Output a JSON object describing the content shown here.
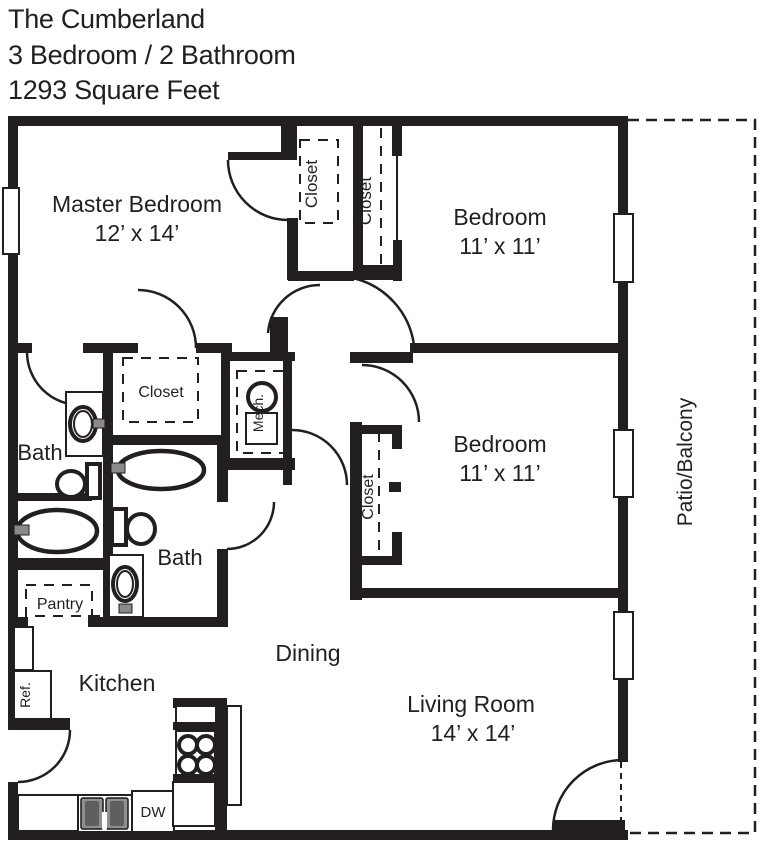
{
  "header": {
    "title": "The Cumberland",
    "subtitle": "3 Bedroom / 2 Bathroom",
    "area": "1293 Square Feet"
  },
  "rooms": {
    "master_bedroom": {
      "label": "Master Bedroom",
      "dims": "12’ x 14’"
    },
    "bedroom_top": {
      "label": "Bedroom",
      "dims": "11’ x 11’"
    },
    "bedroom_middle": {
      "label": "Bedroom",
      "dims": "11’ x 11’"
    },
    "living_room": {
      "label": "Living Room",
      "dims": "14’ x 14’"
    },
    "dining": {
      "label": "Dining"
    },
    "kitchen": {
      "label": "Kitchen"
    },
    "bath_master": {
      "label": "Bath"
    },
    "bath_hall": {
      "label": "Bath"
    },
    "patio": {
      "label": "Patio/Balcony"
    }
  },
  "features": {
    "closet_walkin": {
      "label": "Closet"
    },
    "closet_hall": {
      "label": "Closet"
    },
    "closet_master": {
      "label": "Closet"
    },
    "closet_bedroom": {
      "label": "Closet"
    },
    "mechanical": {
      "label": "Mech."
    },
    "pantry": {
      "label": "Pantry"
    },
    "refrigerator": {
      "label": "Ref."
    },
    "dishwasher": {
      "label": "DW"
    }
  },
  "colors": {
    "wall": "#231f20",
    "text": "#231f20",
    "background": "#ffffff"
  }
}
